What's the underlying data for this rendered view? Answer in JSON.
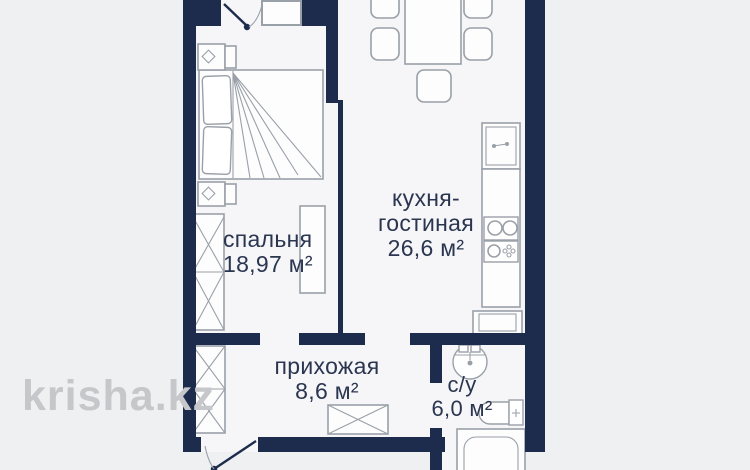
{
  "watermark": "krisha.kz",
  "rooms": {
    "bedroom": {
      "name": "спальня",
      "area": "18,97 м²"
    },
    "kitchen_living": {
      "lines": [
        "кухня-",
        "гостиная"
      ],
      "area": "26,6 м²"
    },
    "hallway": {
      "name": "прихожая",
      "area": "8,6 м²"
    },
    "bathroom": {
      "name": "с/у",
      "area": "6,0 м²"
    }
  },
  "colors": {
    "wall": "#1d2b4c",
    "floor": "#f6f6f8",
    "bg": "#eff0f2",
    "line": "#9aa0a8",
    "text": "#2a3550",
    "watermark": "#c6c7ca"
  }
}
